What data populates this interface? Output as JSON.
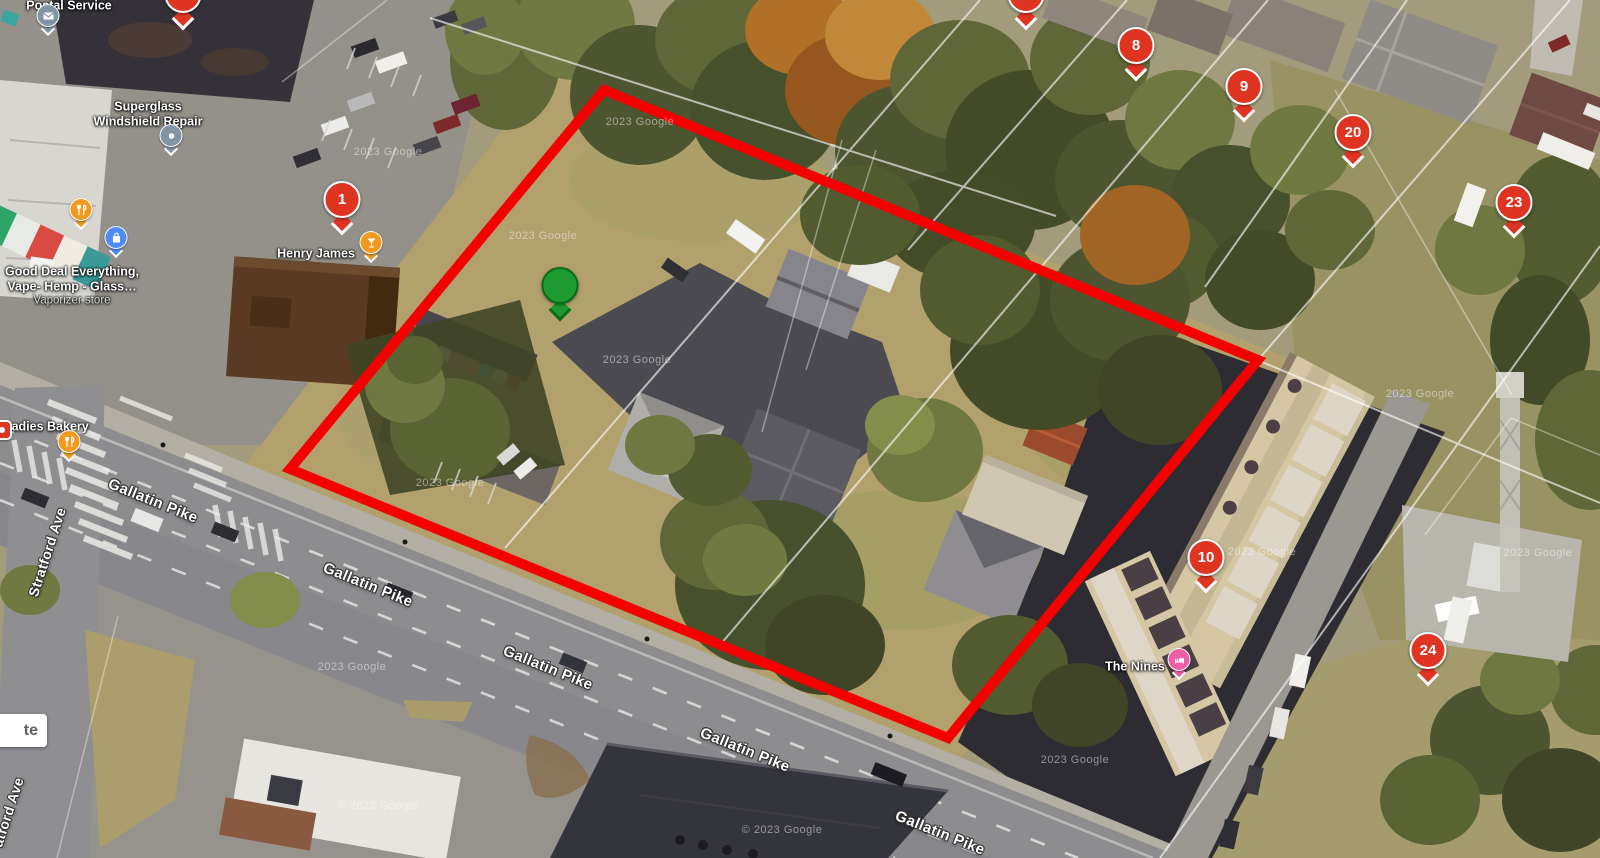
{
  "map": {
    "watermark": "2023 Google",
    "watermark_copyright": "© 2023 Google"
  },
  "streets": {
    "gallatin_pike": "Gallatin Pike",
    "stratford_ave": "Stratford Ave",
    "stratford_ave_partial": "atford Ave"
  },
  "pois": {
    "postal_service": {
      "name": "Postal Service"
    },
    "superglass": {
      "line1": "Superglass",
      "line2": "Windshield Repair"
    },
    "good_deal": {
      "line1": "Good Deal Everything,",
      "line2": "Vape- Hemp - Glass…",
      "subtitle": "Vaporizer store"
    },
    "henry_james": {
      "name": "Henry James"
    },
    "sadies_bakery": {
      "name": "Sadies Bakery"
    },
    "the_nines": {
      "name": "The Nines"
    },
    "edge_label": {
      "text": "te"
    }
  },
  "markers": {
    "m1": {
      "label": "1"
    },
    "m8": {
      "label": "8"
    },
    "m9": {
      "label": "9"
    },
    "m10": {
      "label": "10"
    },
    "m20": {
      "label": "20"
    },
    "m23": {
      "label": "23"
    },
    "m24": {
      "label": "24"
    },
    "partial_top_left": {
      "label": ""
    },
    "partial_top_center": {
      "label": ""
    },
    "green_pin": {
      "label": ""
    }
  },
  "colors": {
    "marker_red": "#e03422",
    "marker_green": "#1d9b31",
    "poi_orange": "#f09a1f",
    "poi_blue": "#4f8df5",
    "poi_gray": "#8295a5",
    "poi_pink": "#ef5fa7",
    "boundary_red": "#f40000"
  }
}
